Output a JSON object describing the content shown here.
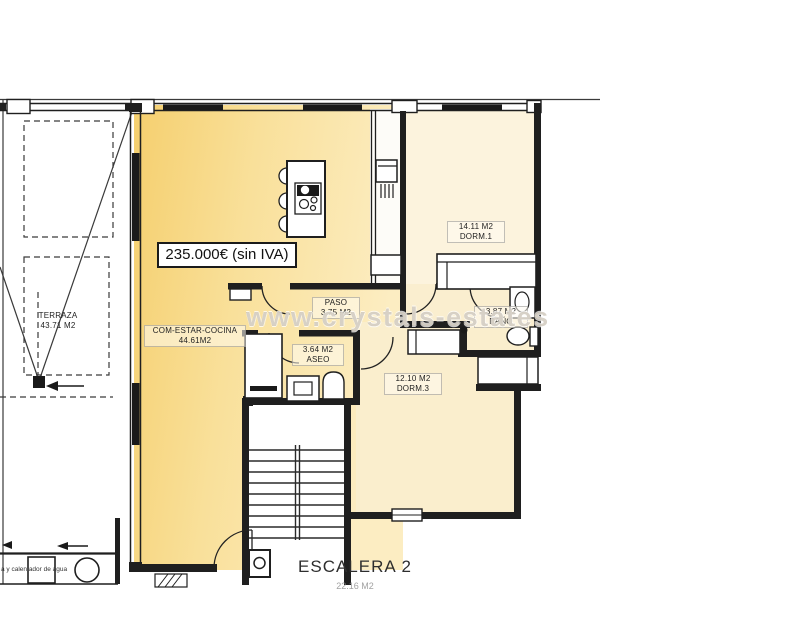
{
  "watermark": "www.crystals-estates",
  "price": {
    "label": "235.000€ (sin IVA)"
  },
  "rooms": {
    "terraza": {
      "name": "TERRAZA",
      "area": "43.71 M2"
    },
    "living": {
      "name": "COM-ESTAR-COCINA",
      "area": "44.61M2"
    },
    "paso": {
      "name": "PASO",
      "area": "3.75 M2"
    },
    "aseo": {
      "name": "ASEO",
      "area": "3.64 M2"
    },
    "dorm1": {
      "name": "DORM.1",
      "area": "14.11 M2"
    },
    "bano": {
      "name": "BAÑO",
      "area": "3.87 M2"
    },
    "dorm3": {
      "name": "DORM.3",
      "area": "12.10 M2"
    },
    "escalera": {
      "name": "ESCALERA 2",
      "area": "22.16 M2"
    }
  },
  "annotations": {
    "utility": "a y calentador de agua"
  },
  "colors": {
    "living_left": "#f5cf6e",
    "living_mid": "#f9e09a",
    "living_right": "#fcedc2",
    "room_pale": "#fbf2dc",
    "wall": "#1f1f1f"
  }
}
